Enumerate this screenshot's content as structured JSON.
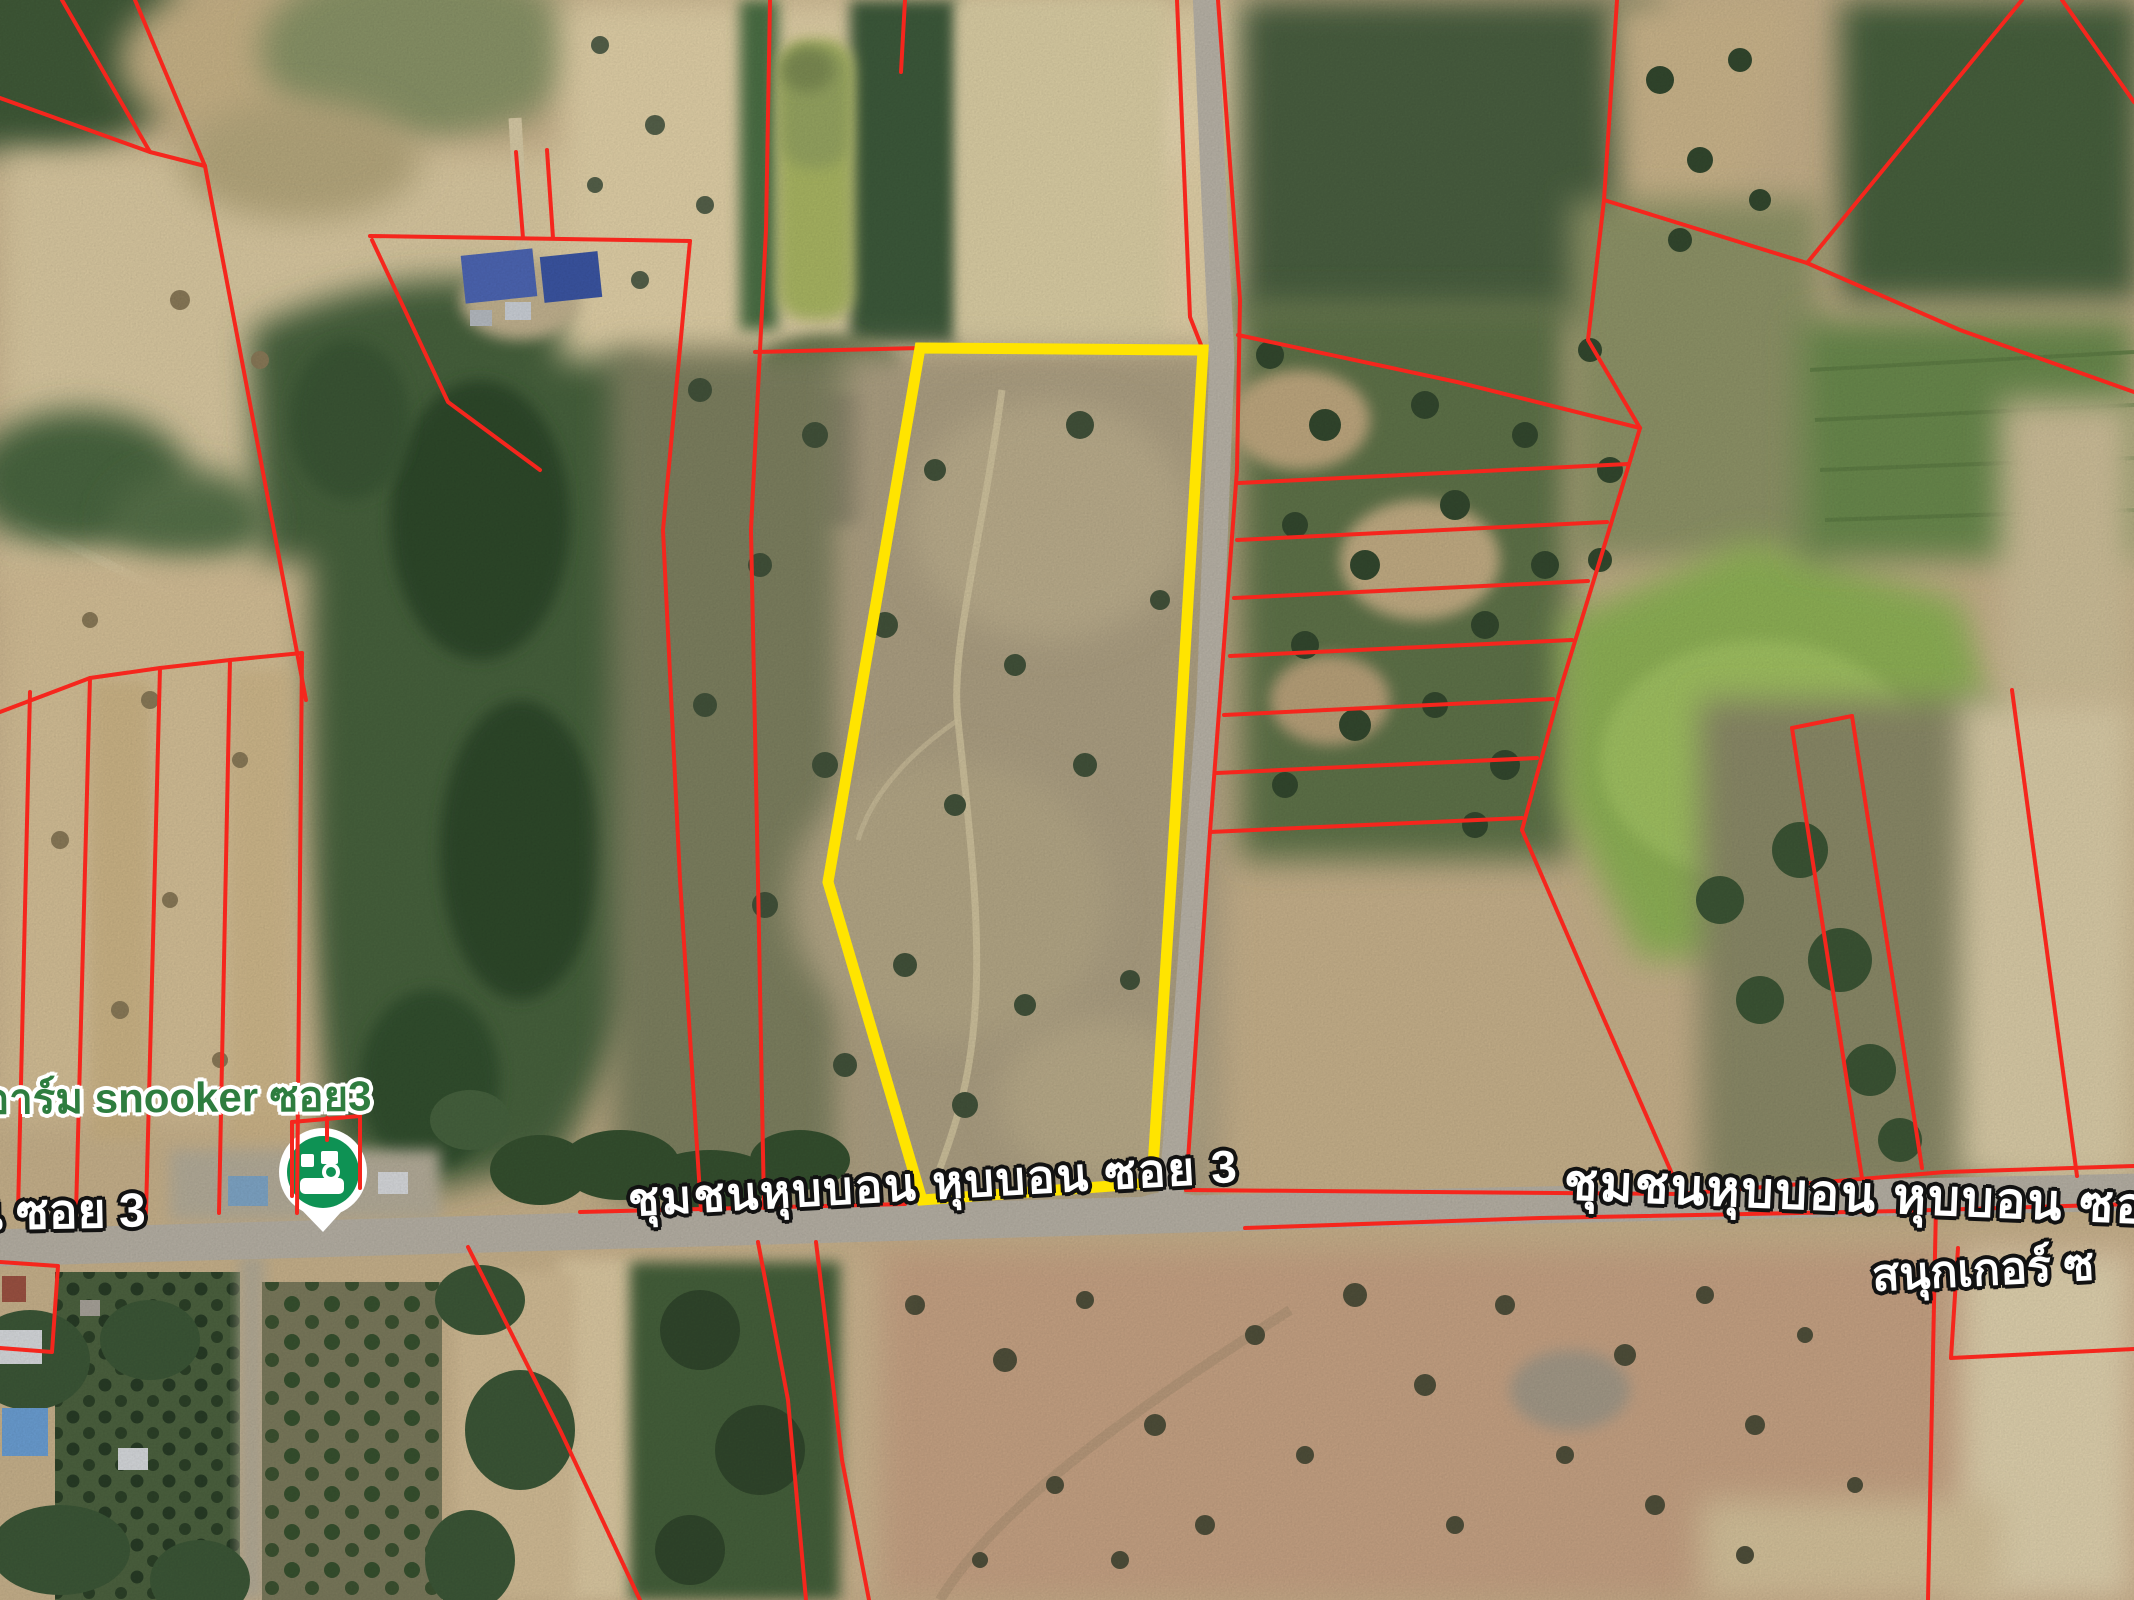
{
  "map": {
    "poi": {
      "label": "อาร์ม snooker ซอย3",
      "icon": "snooker-pin-icon",
      "pin_color": "#0e9254"
    },
    "road_labels": {
      "left": "น ซอย 3",
      "center": "ชุมชนหุบบอน หุบบอน ซอย 3",
      "right": "ชุมชนหุบบอน หุบบอน ซอ",
      "bottom_right": "สนุกเกอร์ ซ"
    },
    "overlays": {
      "parcel_boundary_color": "#f5261d",
      "highlight_plot_color": "#ffe400",
      "highlight_plot_points": "920,348 1203,350 1175,820 1152,1183 922,1200 828,882"
    }
  }
}
